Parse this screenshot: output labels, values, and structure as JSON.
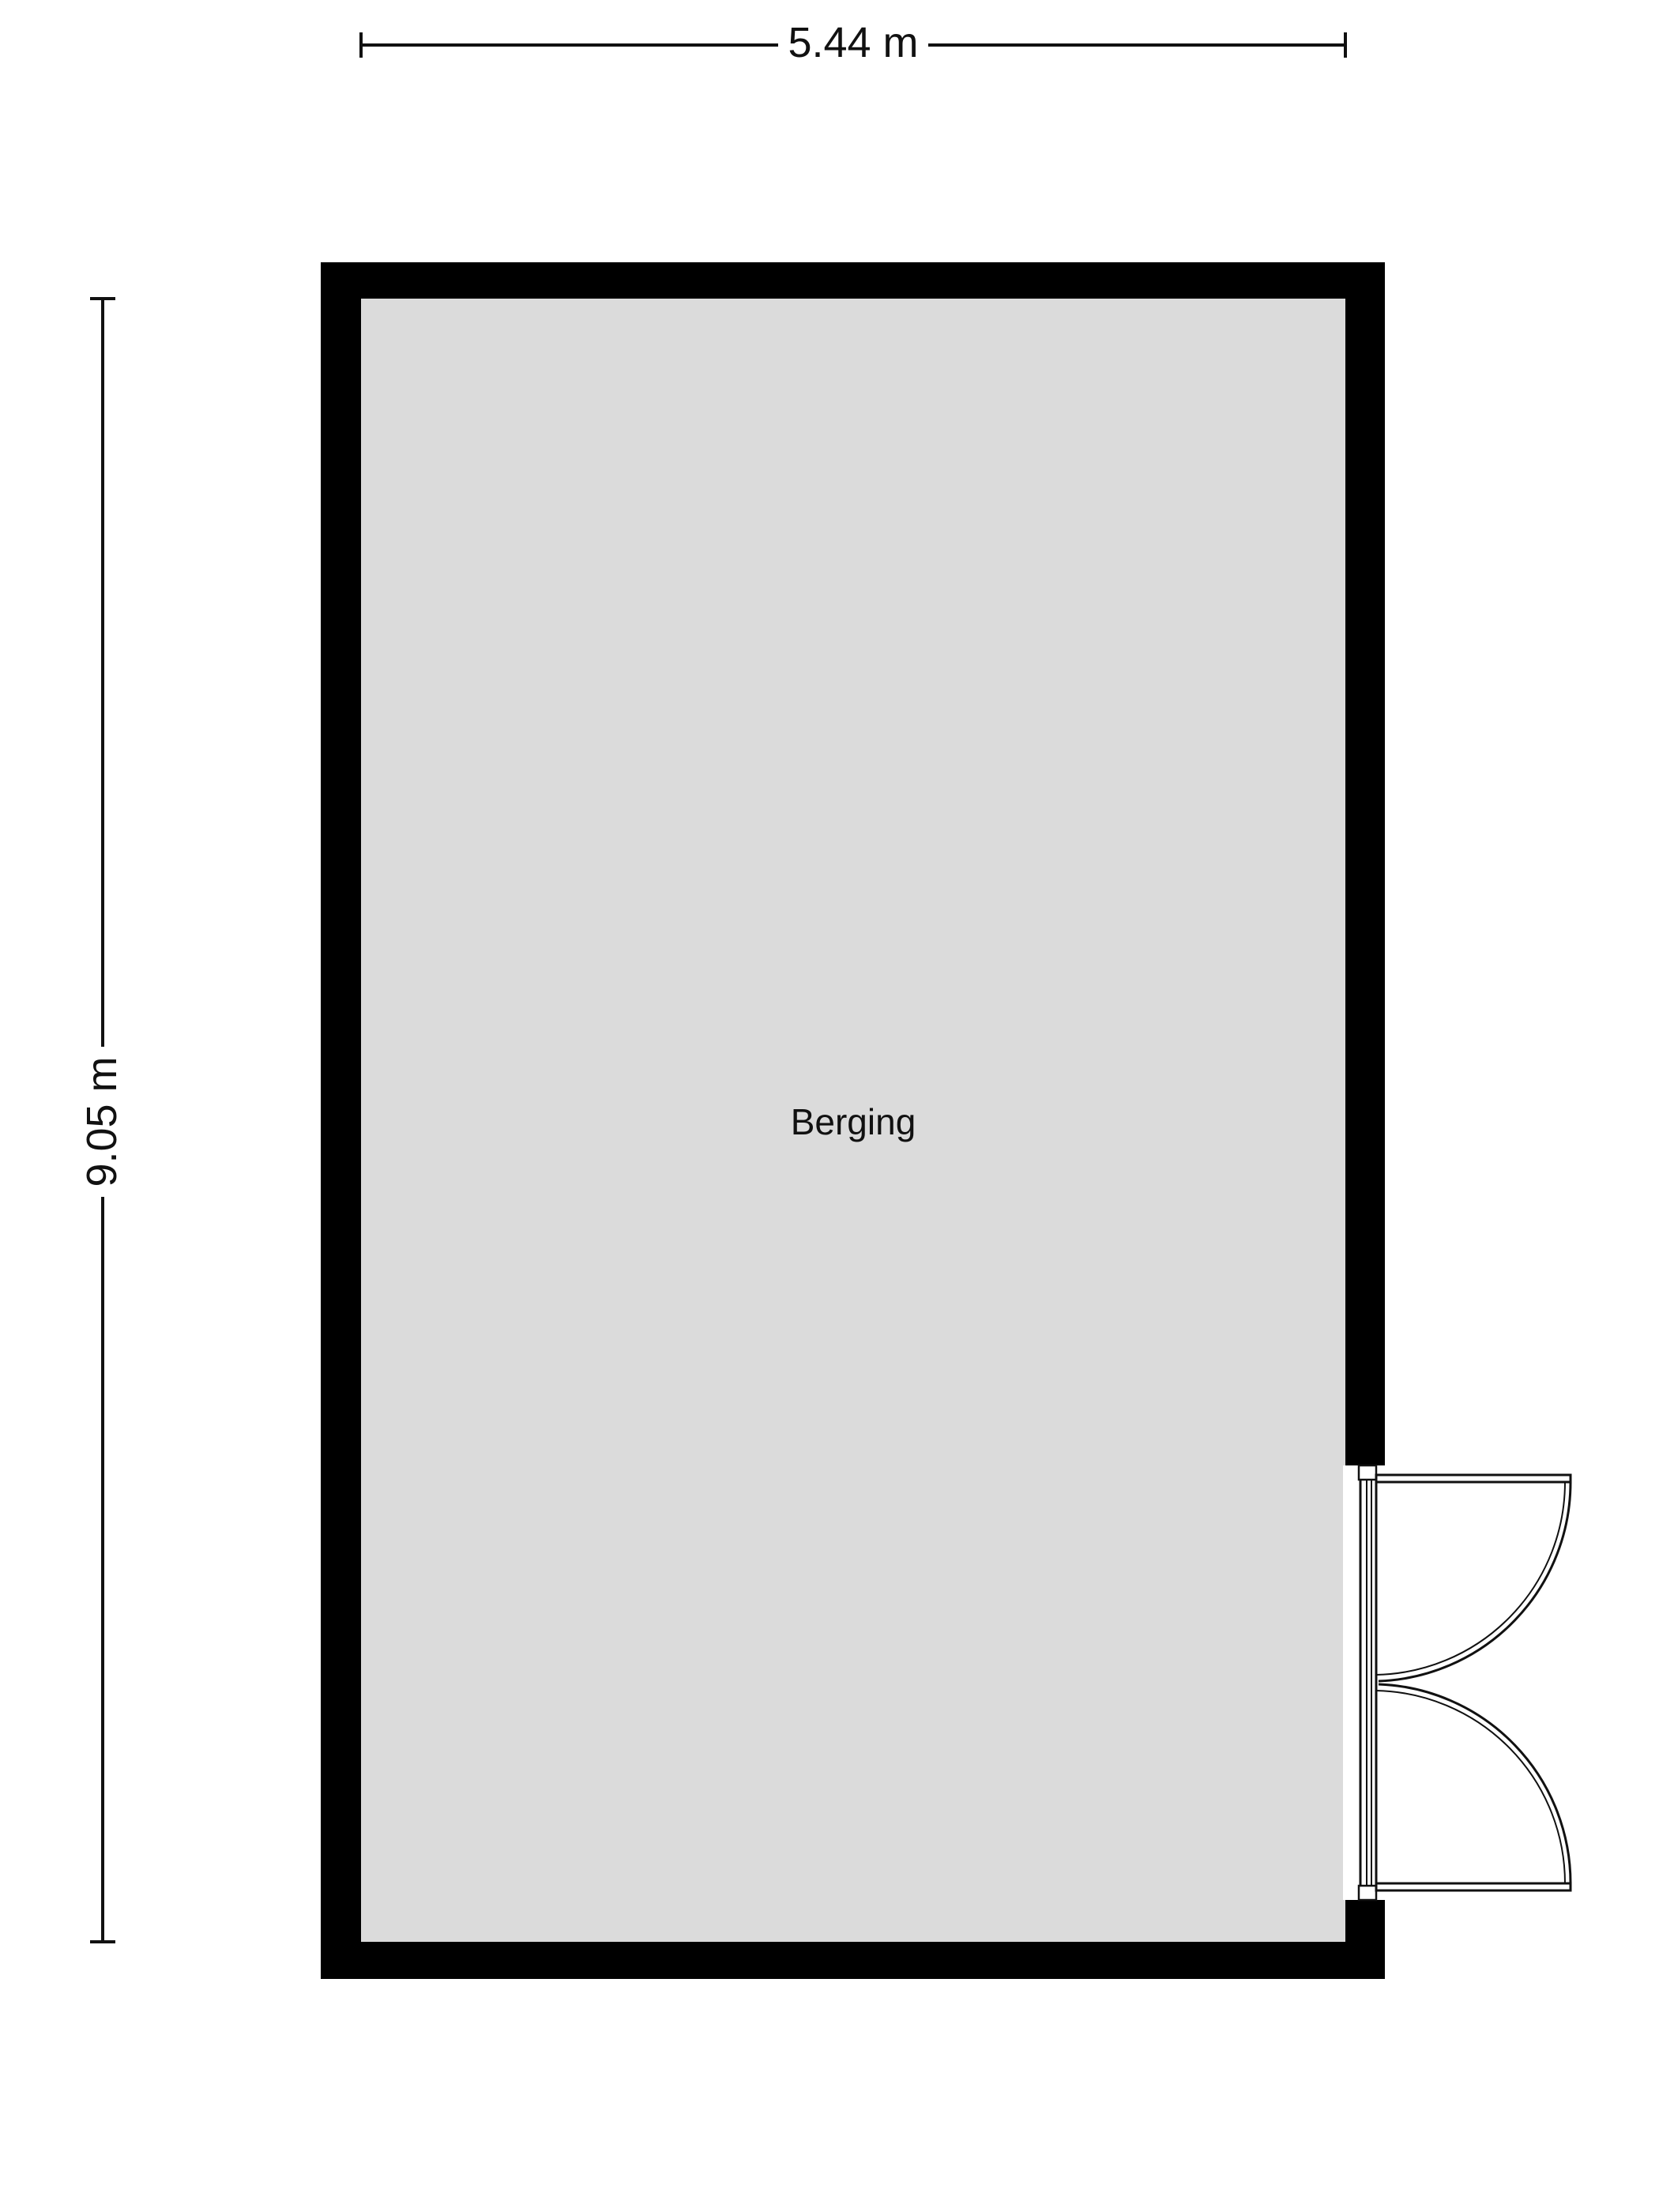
{
  "floorplan": {
    "room": {
      "label": "Berging"
    },
    "dimensions": {
      "width_label": "5.44 m",
      "height_label": "9.05 m"
    },
    "colors": {
      "wall": "#000000",
      "floor": "#dbdbdb",
      "line": "#111111",
      "text": "#111111",
      "background": "#ffffff"
    }
  }
}
